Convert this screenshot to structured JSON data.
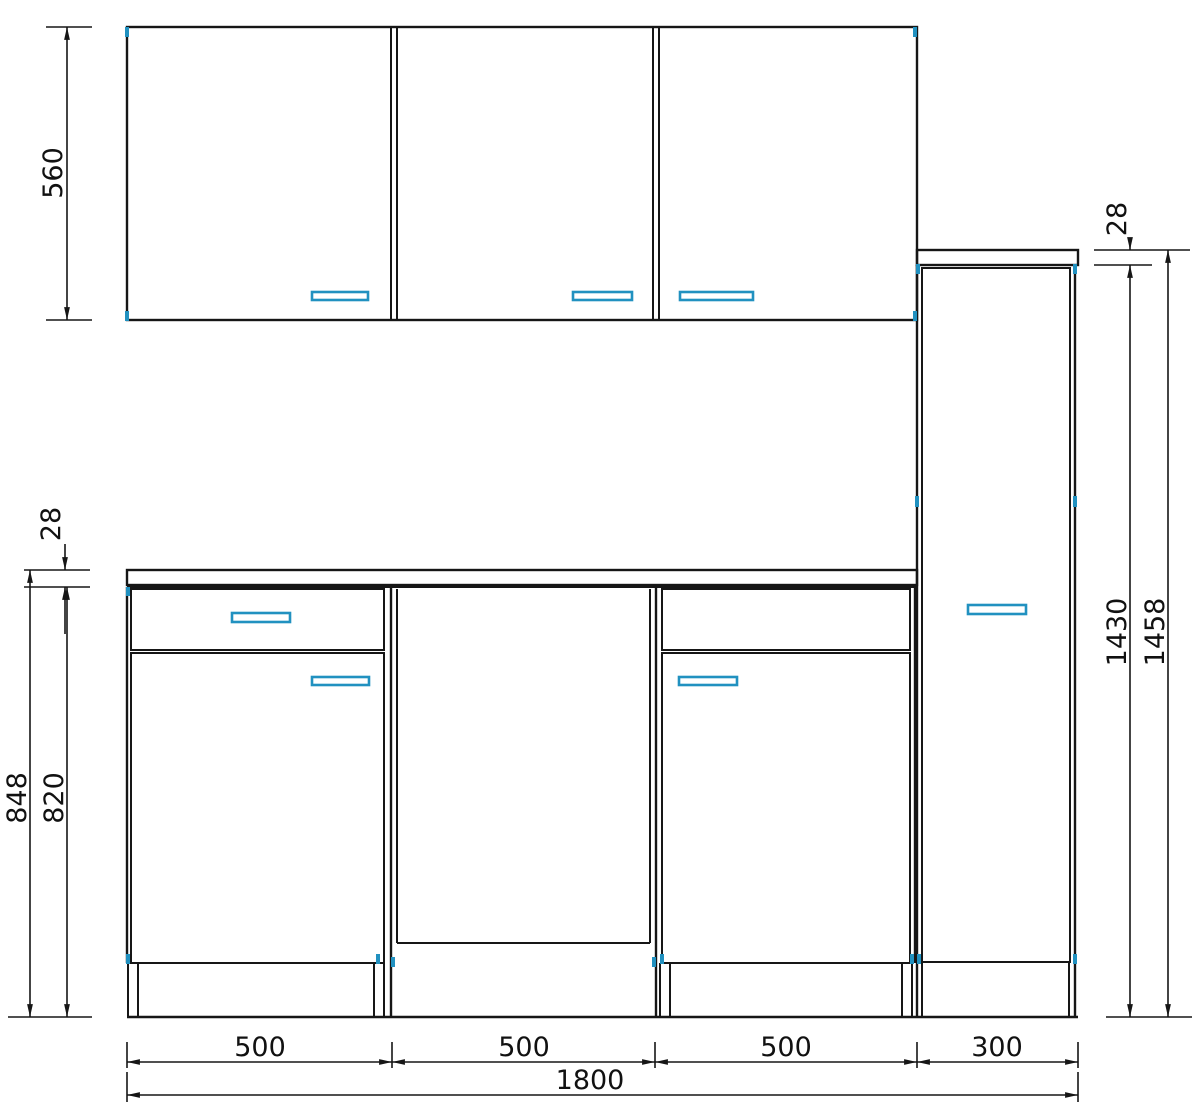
{
  "drawing": {
    "kind": "kitchen-cabinet-elevation",
    "colors": {
      "line": "#161616",
      "accent": "#2191c0",
      "background": "#ffffff"
    }
  },
  "dims": {
    "left": {
      "wall_cabinet_height": "560",
      "worktop_thickness": "28",
      "base_total_height": "848",
      "base_cabinet_height": "820"
    },
    "right": {
      "top_panel_thickness": "28",
      "tall_cabinet_height": "1430",
      "tall_total_height": "1458"
    },
    "bottom": {
      "segment_widths": [
        "500",
        "500",
        "500",
        "300"
      ],
      "total_width": "1800"
    }
  }
}
